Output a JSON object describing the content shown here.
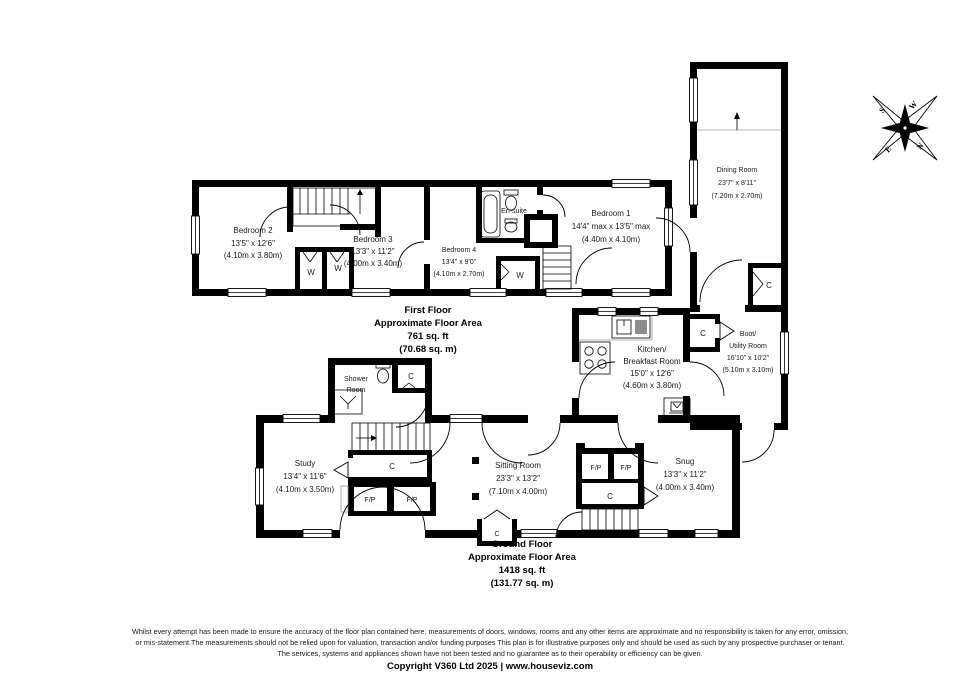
{
  "compass": {
    "n": "N",
    "e": "E",
    "s": "S",
    "w": "W"
  },
  "first_floor": {
    "caption": {
      "title": "First Floor",
      "subtitle": "Approximate Floor Area",
      "area_ft": "761 sq. ft",
      "area_m": "(70.68 sq. m)"
    },
    "bedroom1": {
      "name": "Bedroom 1",
      "dims_ft": "14'4\" max x 13'5\" max",
      "dims_m": "(4.40m x 4.10m)"
    },
    "bedroom2": {
      "name": "Bedroom 2",
      "dims_ft": "13'5\" x 12'6\"",
      "dims_m": "(4.10m x 3.80m)"
    },
    "bedroom3": {
      "name": "Bedroom 3",
      "dims_ft": "13'3\" x 11'2\"",
      "dims_m": "(4.00m x 3.40m)"
    },
    "bedroom4": {
      "name": "Bedroom 4",
      "dims_ft": "13'4\" x 9'0\"",
      "dims_m": "(4.10m x 2.70m)"
    },
    "ensuite": {
      "name": "En-suite"
    },
    "wardrobe_label": "W"
  },
  "ground_floor": {
    "caption": {
      "title": "Ground Floor",
      "subtitle": "Approximate Floor Area",
      "area_ft": "1418 sq. ft",
      "area_m": "(131.77 sq. m)"
    },
    "dining": {
      "name": "Dining Room",
      "dims_ft": "23'7\" x 8'11\"",
      "dims_m": "(7.20m x 2.70m)"
    },
    "kitchen": {
      "name_line1": "Kitchen/",
      "name_line2": "Breakfast Room",
      "dims_ft": "15'0\" x 12'6\"",
      "dims_m": "(4.60m x 3.80m)"
    },
    "boot": {
      "name_line1": "Boot/",
      "name_line2": "Utility Room",
      "dims_ft": "16'10\" x 10'2\"",
      "dims_m": "(5.10m x 3.10m)"
    },
    "shower": {
      "name_line1": "Shower",
      "name_line2": "Room"
    },
    "study": {
      "name": "Study",
      "dims_ft": "13'4\" x 11'6\"",
      "dims_m": "(4.10m x 3.50m)"
    },
    "sitting": {
      "name": "Sitting Room",
      "dims_ft": "23'3\" x 13'2\"",
      "dims_m": "(7.10m x 4.00m)"
    },
    "snug": {
      "name": "Snug",
      "dims_ft": "13'3\" x 11'2\"",
      "dims_m": "(4.00m x 3.40m)"
    },
    "cupboard_label": "C",
    "fireplace_label": "F/P"
  },
  "footer": {
    "disclaimer": [
      "Whilst every attempt has been made to ensure the accuracy of the floor plan contained here, measurements of doors, windows, rooms and any other items are approximate and no responsibility is taken for any error, omission,",
      "or mis-statement.The measurements should not be relied upon for valuation, transaction and/or funding purposes This plan is for illustrative purposes only and should be used as such by any prospective purchaser or tenant.",
      "The services, systems and appliances shown have not been tested and no guarantee as to their operability or efficiency can be given."
    ],
    "copyright": "Copyright V360 Ltd 2025 | www.houseviz.com"
  },
  "colors": {
    "wall": "#000000",
    "background": "#ffffff"
  }
}
